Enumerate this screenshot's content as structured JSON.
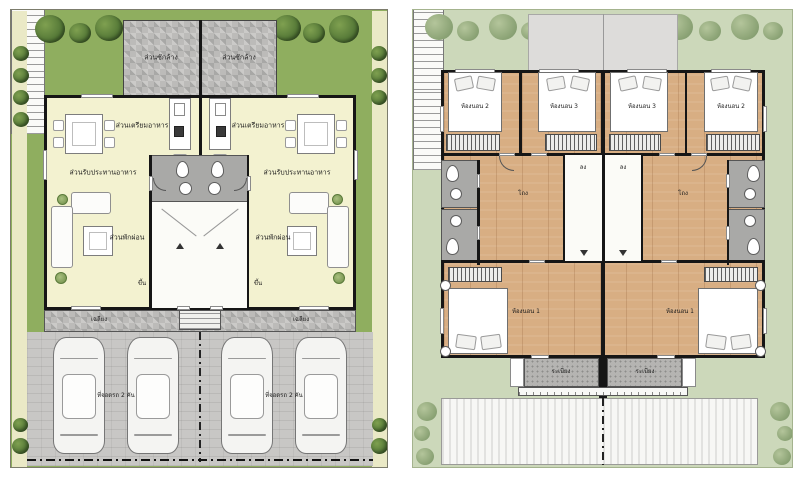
{
  "first_floor": {
    "laundry": "ส่วนซักล้าง",
    "pantry": "ส่วนเตรียมอาหาร",
    "dining": "ส่วนรับประทานอาหาร",
    "living": "ส่วนพักผ่อน",
    "stairs_up": "ขึ้น",
    "porch": "เฉลียง",
    "parking": "ที่จอดรถ 2 คัน"
  },
  "second_floor": {
    "bedroom_1": "ห้องนอน 1",
    "bedroom_2": "ห้องนอน 2",
    "bedroom_3": "ห้องนอน 3",
    "hall": "โถง",
    "stairs_down": "ลง",
    "balcony": "ระเบียง"
  },
  "colors": {
    "lawn_green": "#8fae5f",
    "pale_path": "#eae9c6",
    "surround_green": "#ccd8ba",
    "interior_cream": "#f3f2d0",
    "wood_floor": "#d8ae83",
    "bath_gray": "#a9a9a7",
    "paving_gray": "#c8c7c5",
    "wall_black": "#161616",
    "roof_gray": "#dddcda"
  }
}
